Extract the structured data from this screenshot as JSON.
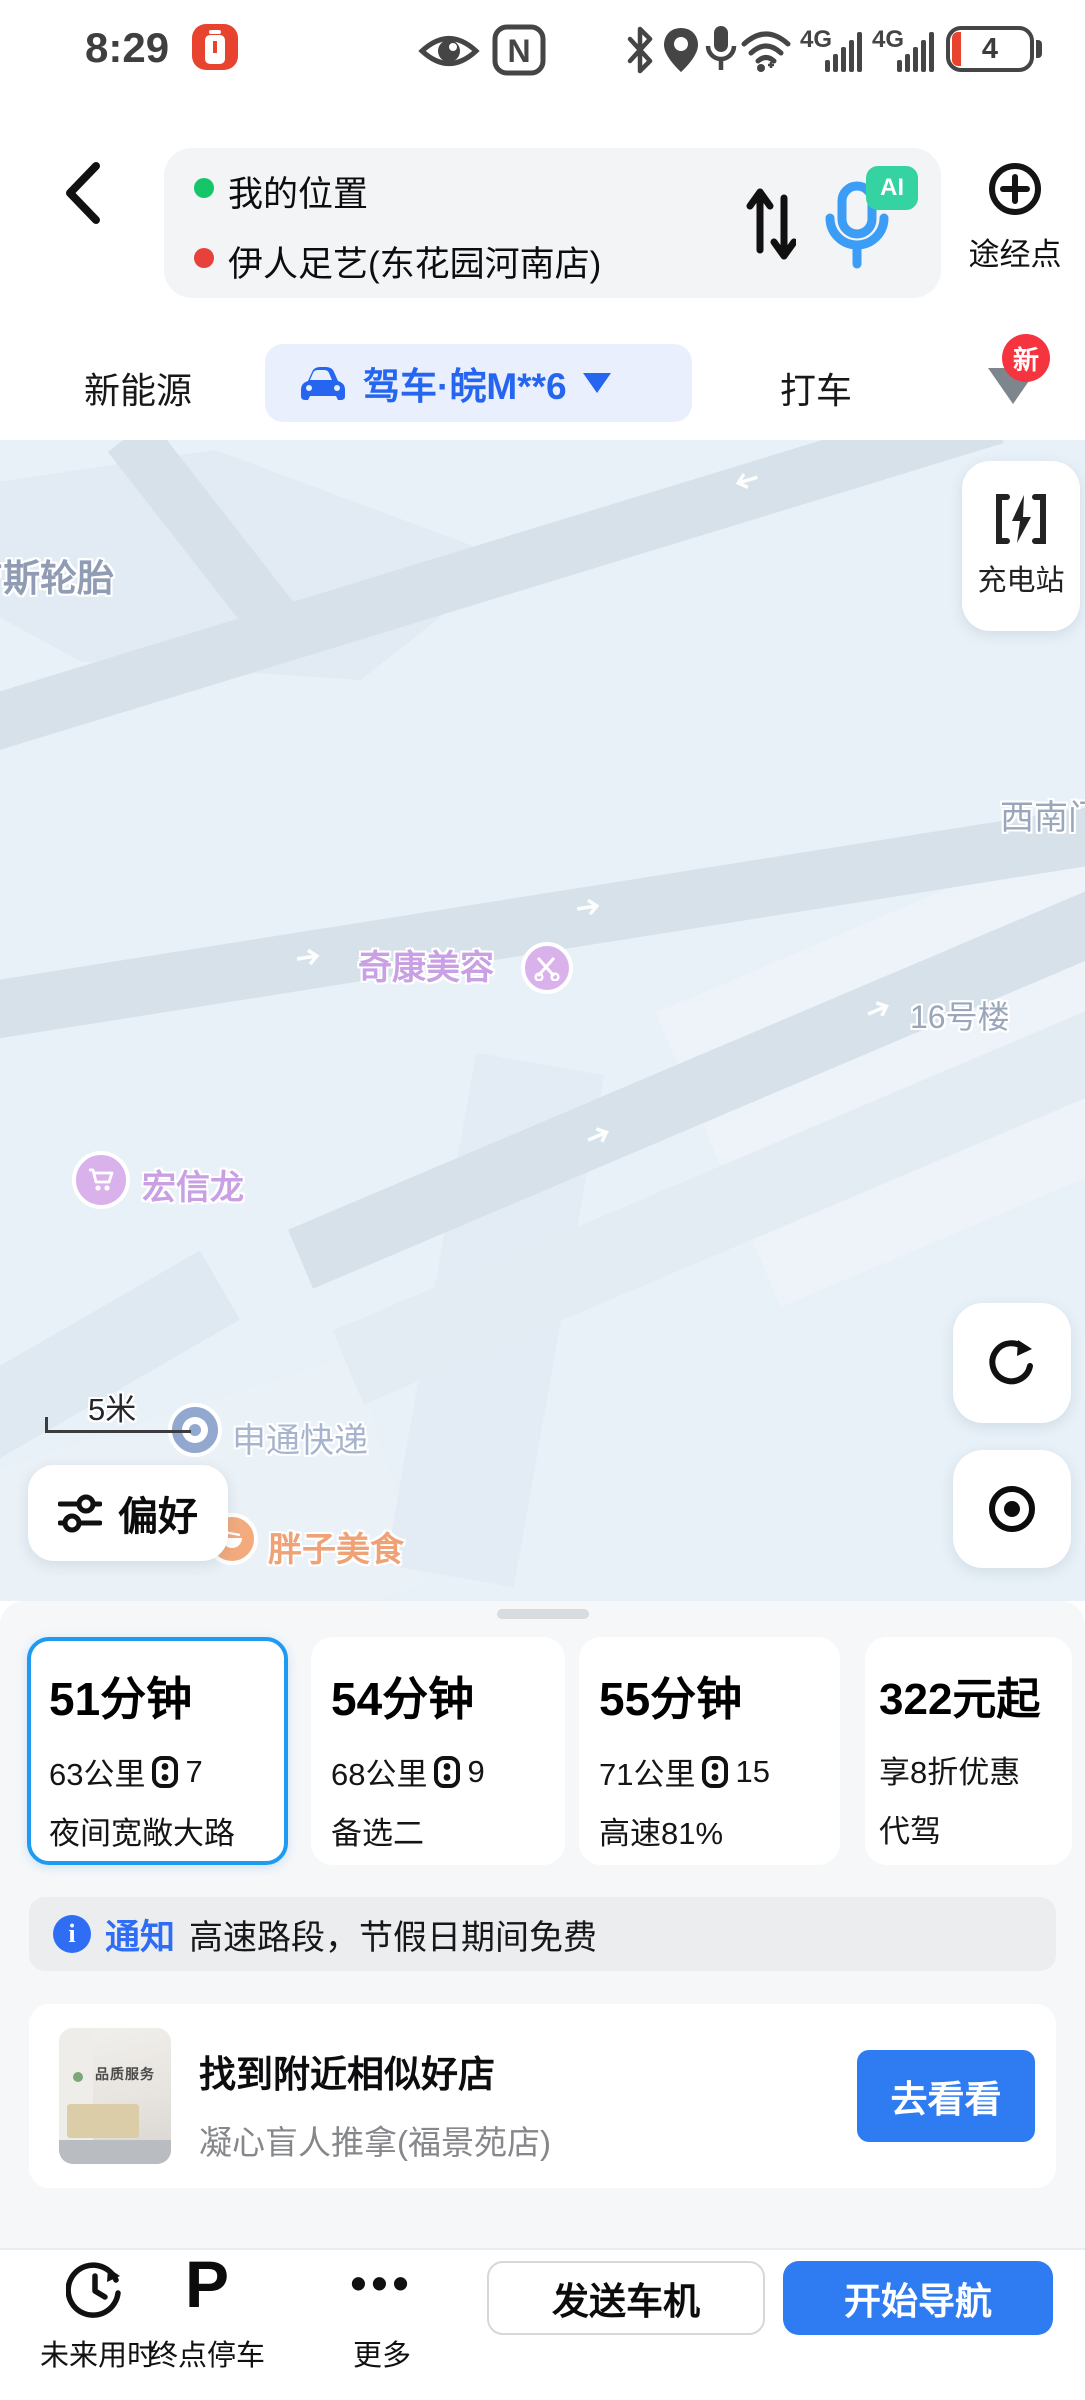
{
  "status_bar": {
    "time": "8:29",
    "battery": "4",
    "net1": "4G",
    "net2": "4G"
  },
  "header": {
    "origin": "我的位置",
    "destination": "伊人足艺(东花园河南店)",
    "waypoint": "途经点",
    "ai_badge": "AI"
  },
  "tabs": {
    "energy": "新能源",
    "drive": "驾车·皖M**6",
    "taxi": "打车",
    "new_badge": "新"
  },
  "map": {
    "scale": "5米",
    "charging": "充电站",
    "preference": "偏好",
    "labels": {
      "tire": "吉斯轮胎",
      "southwest_gate": "西南门",
      "beauty": "奇康美容",
      "building16": "16号楼",
      "hongxinlong": "宏信龙",
      "sto": "申通快递",
      "pangzi": "胖子美食"
    }
  },
  "routes": [
    {
      "time": "51分钟",
      "distance": "63公里",
      "lights": "7",
      "tag": "夜间宽敞大路"
    },
    {
      "time": "54分钟",
      "distance": "68公里",
      "lights": "9",
      "tag": "备选二"
    },
    {
      "time": "55分钟",
      "distance": "71公里",
      "lights": "15",
      "tag": "高速81%"
    },
    {
      "price": "322元起",
      "discount": "享8折优惠",
      "tag": "代驾"
    }
  ],
  "notice": {
    "label": "通知",
    "text": "高速路段，节假日期间免费"
  },
  "ad": {
    "title": "找到附近相似好店",
    "subtitle": "凝心盲人推拿(福景苑店)",
    "button": "去看看",
    "thumb_caption": "品质服务"
  },
  "bottom_bar": {
    "future": "未来用时",
    "parking": "终点停车",
    "more": "更多",
    "send": "发送车机",
    "start": "开始导航"
  },
  "colors": {
    "accent_blue": "#2e7bf2",
    "selected_border": "#1e9bf0",
    "discount_orange": "#e8512d",
    "badge_red": "#f5343f",
    "map_bg": "#e8f1f8",
    "road": "#d7e1e9"
  }
}
